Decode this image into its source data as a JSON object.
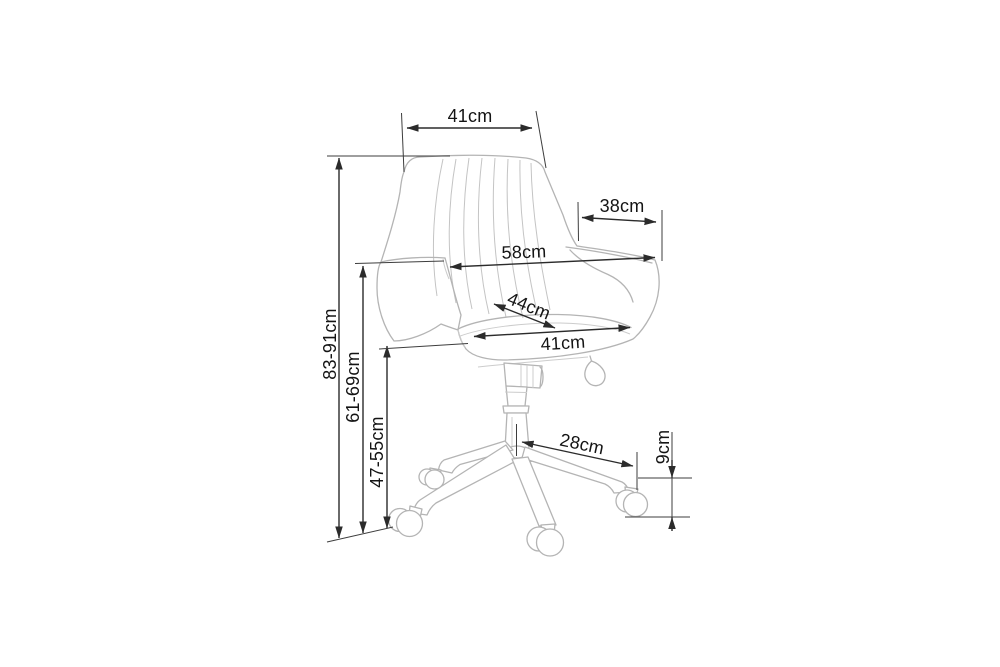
{
  "canvas": {
    "width": 1000,
    "height": 667,
    "background": "#ffffff"
  },
  "drawing": {
    "subject": "office swivel chair, three-quarter view line drawing",
    "unit": "cm",
    "colors": {
      "dimension_lines": "#2b2b2b",
      "label_text": "#141414",
      "chair_lines": "#b4b4b4",
      "background": "#ffffff"
    },
    "dimensions": {
      "backrest_top_width": {
        "label": "41cm",
        "value_cm": 41
      },
      "armrest_depth": {
        "label": "38cm",
        "value_cm": 38
      },
      "overall_width": {
        "label": "58cm",
        "value_cm": 58
      },
      "seat_depth": {
        "label": "44cm",
        "value_cm": 44
      },
      "seat_width": {
        "label": "41cm",
        "value_cm": 41
      },
      "base_leg_reach": {
        "label": "28cm",
        "value_cm": 28
      },
      "caster_height": {
        "label": "9cm",
        "value_cm": 9
      },
      "overall_height": {
        "label": "83-91cm",
        "min_cm": 83,
        "max_cm": 91
      },
      "armrest_height": {
        "label": "61-69cm",
        "min_cm": 61,
        "max_cm": 69
      },
      "seat_height": {
        "label": "47-55cm",
        "min_cm": 47,
        "max_cm": 55
      }
    }
  }
}
